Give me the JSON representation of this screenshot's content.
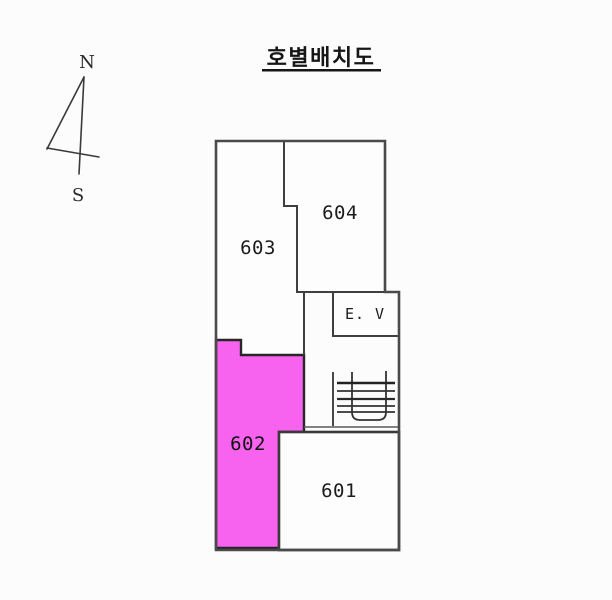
{
  "title": "호별배치도",
  "compass": {
    "north_label": "N",
    "south_label": "S"
  },
  "floorplan": {
    "units": [
      {
        "label": "601",
        "highlighted": false
      },
      {
        "label": "602",
        "highlighted": true
      },
      {
        "label": "603",
        "highlighted": false
      },
      {
        "label": "604",
        "highlighted": false
      }
    ],
    "elevator_label": "E. V",
    "colors": {
      "background": "#fcfcfc",
      "room_fill": "#fdfdfd",
      "highlight": "#f763ef",
      "wall": "#3f3f3f",
      "text": "#1c1c1c"
    }
  }
}
